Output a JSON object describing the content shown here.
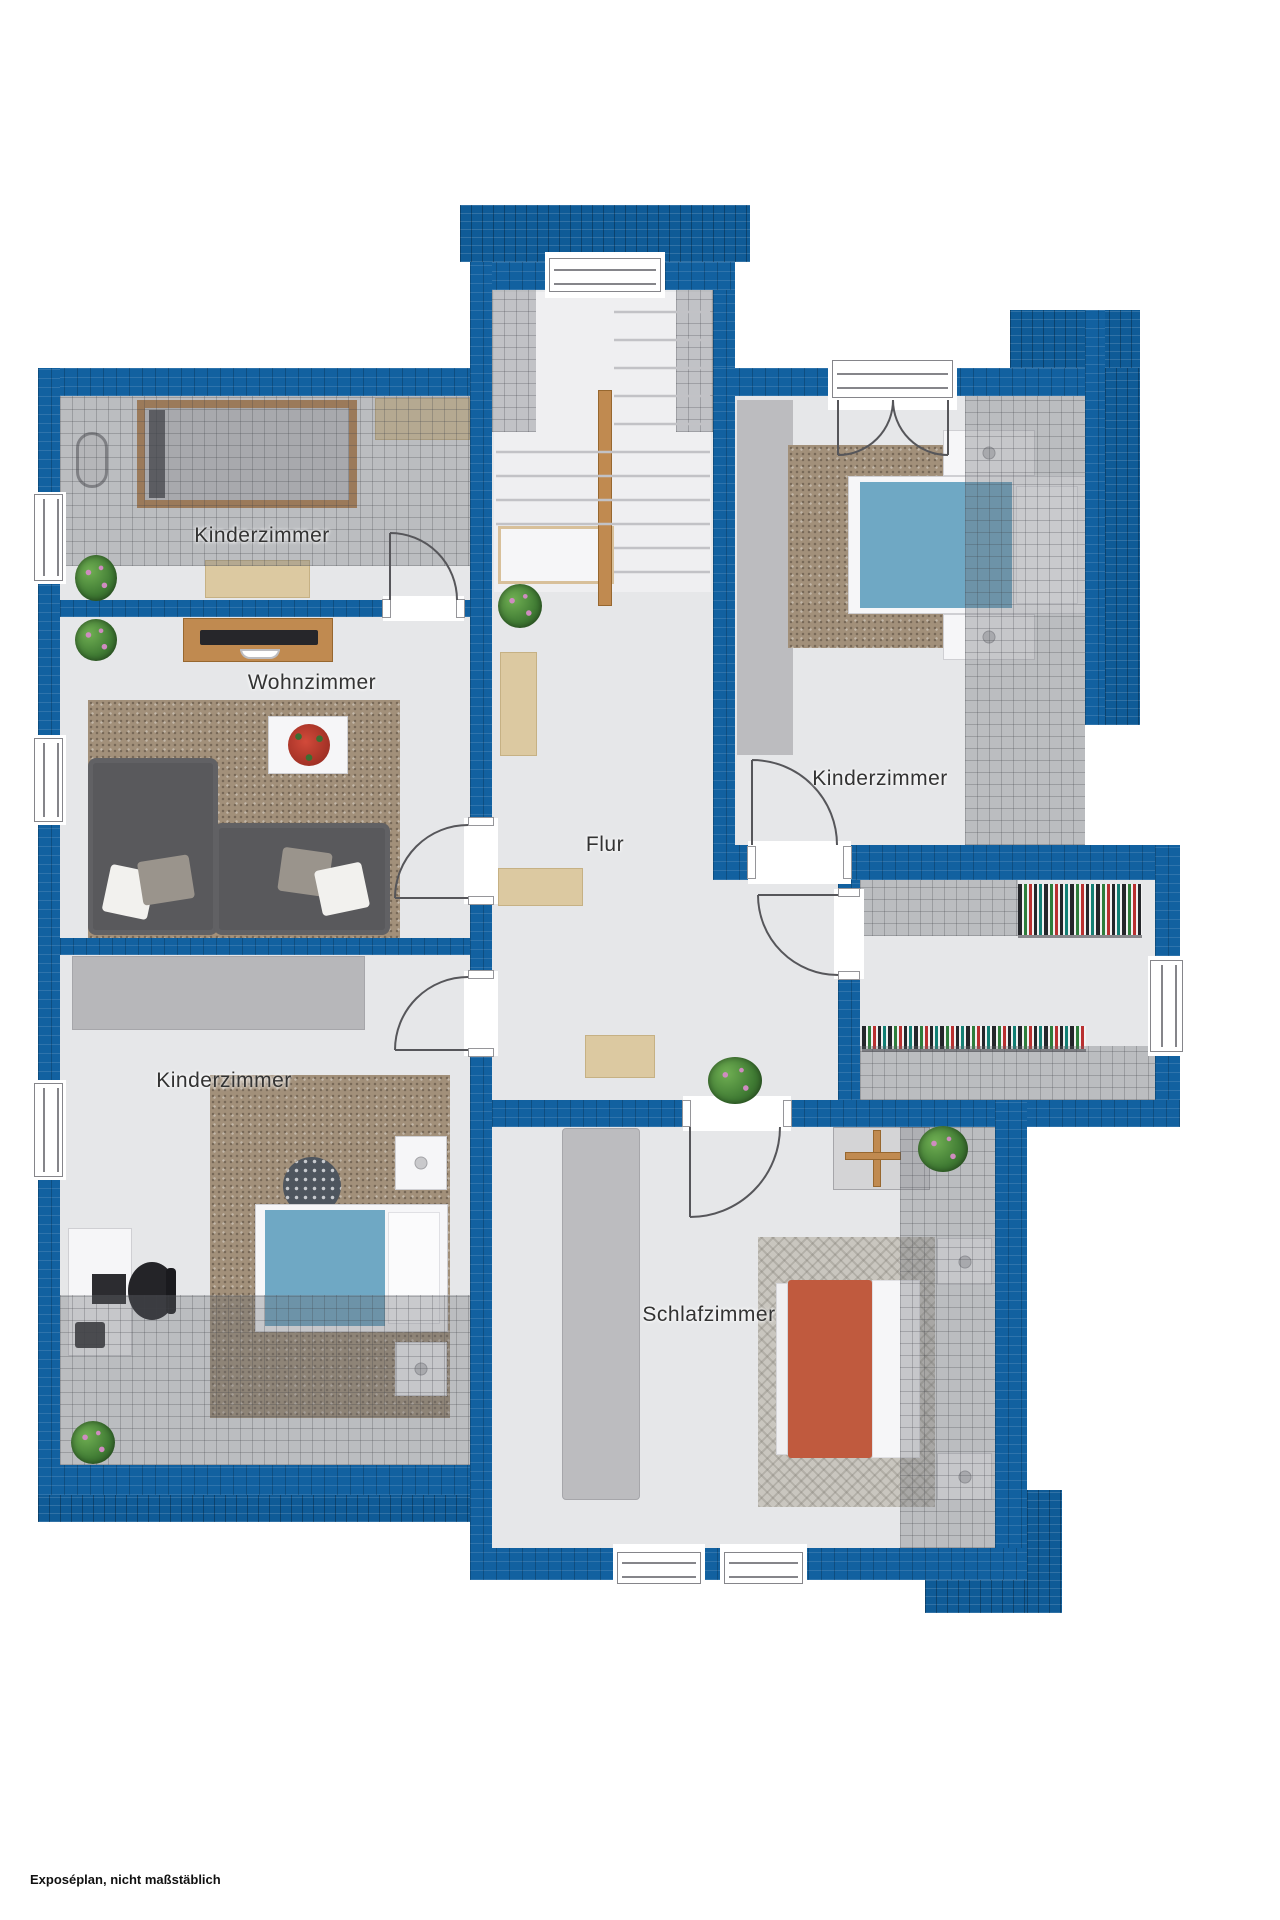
{
  "caption": "Exposéplan, nicht maßstäblich",
  "rooms": [
    {
      "id": "kinderzimmer-top-left",
      "label": "Kinderzimmer"
    },
    {
      "id": "wohnzimmer",
      "label": "Wohnzimmer"
    },
    {
      "id": "kinderzimmer-top-right",
      "label": "Kinderzimmer"
    },
    {
      "id": "flur",
      "label": "Flur"
    },
    {
      "id": "kinderzimmer-bottom-left",
      "label": "Kinderzimmer"
    },
    {
      "id": "schlafzimmer",
      "label": "Schlafzimmer"
    }
  ],
  "colors": {
    "wall_blue": "#1261a0",
    "floor_gray": "#e6e7e9",
    "roof_shading": "#6a6c73",
    "duvet_blue": "#6fa8c4",
    "duvet_red": "#c05a3e",
    "wood": "#c08a50"
  }
}
